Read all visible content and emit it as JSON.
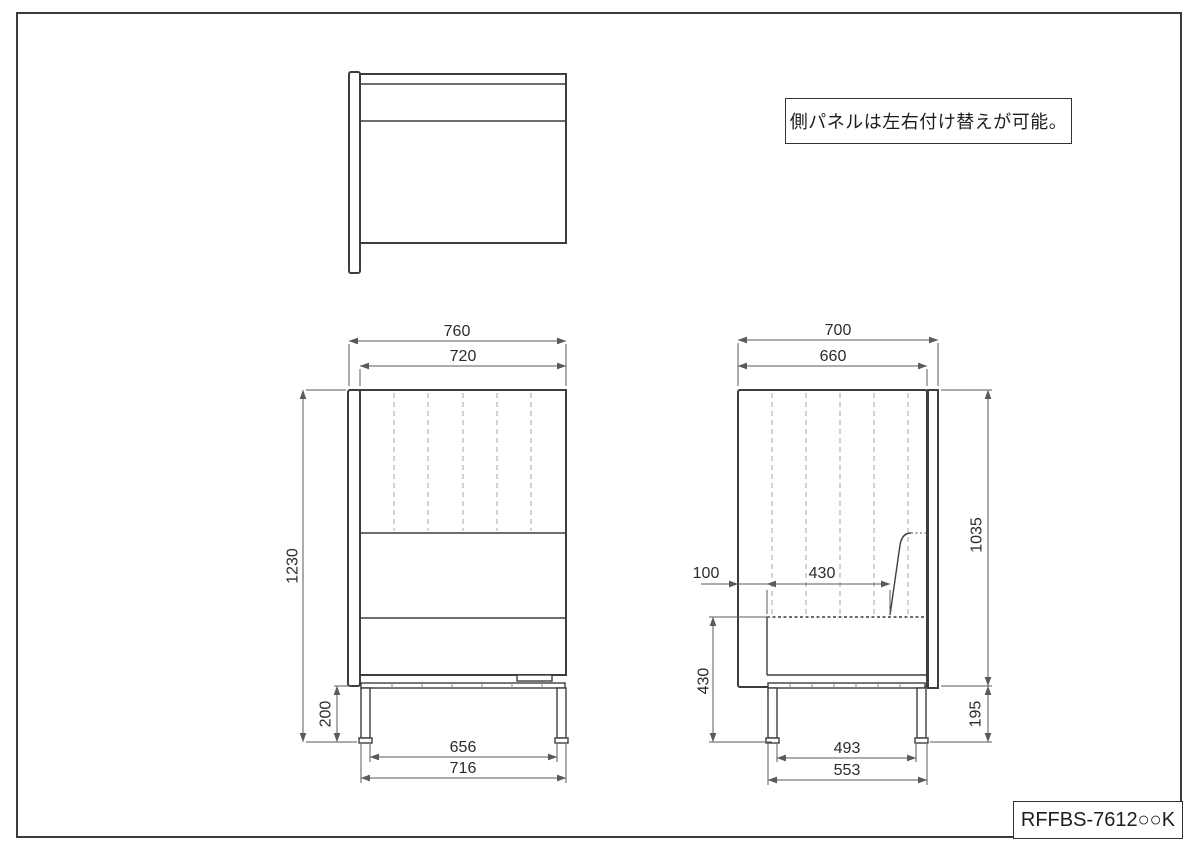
{
  "note": {
    "text": "側パネルは左右付け替えが可能。"
  },
  "title_block": {
    "part_number": "RFFBS-7612○○K"
  },
  "front_view": {
    "dims": {
      "outer_width": "760",
      "inner_width": "720",
      "total_height": "1230",
      "leg_height": "200",
      "leg_inner_span": "656",
      "leg_outer_span": "716"
    }
  },
  "side_view": {
    "dims": {
      "outer_depth": "700",
      "inner_depth": "660",
      "panel_height": "1035",
      "back_offset": "100",
      "seat_depth": "430",
      "seat_height": "430",
      "leg_height": "195",
      "leg_inner_span": "493",
      "leg_outer_span": "553"
    }
  }
}
